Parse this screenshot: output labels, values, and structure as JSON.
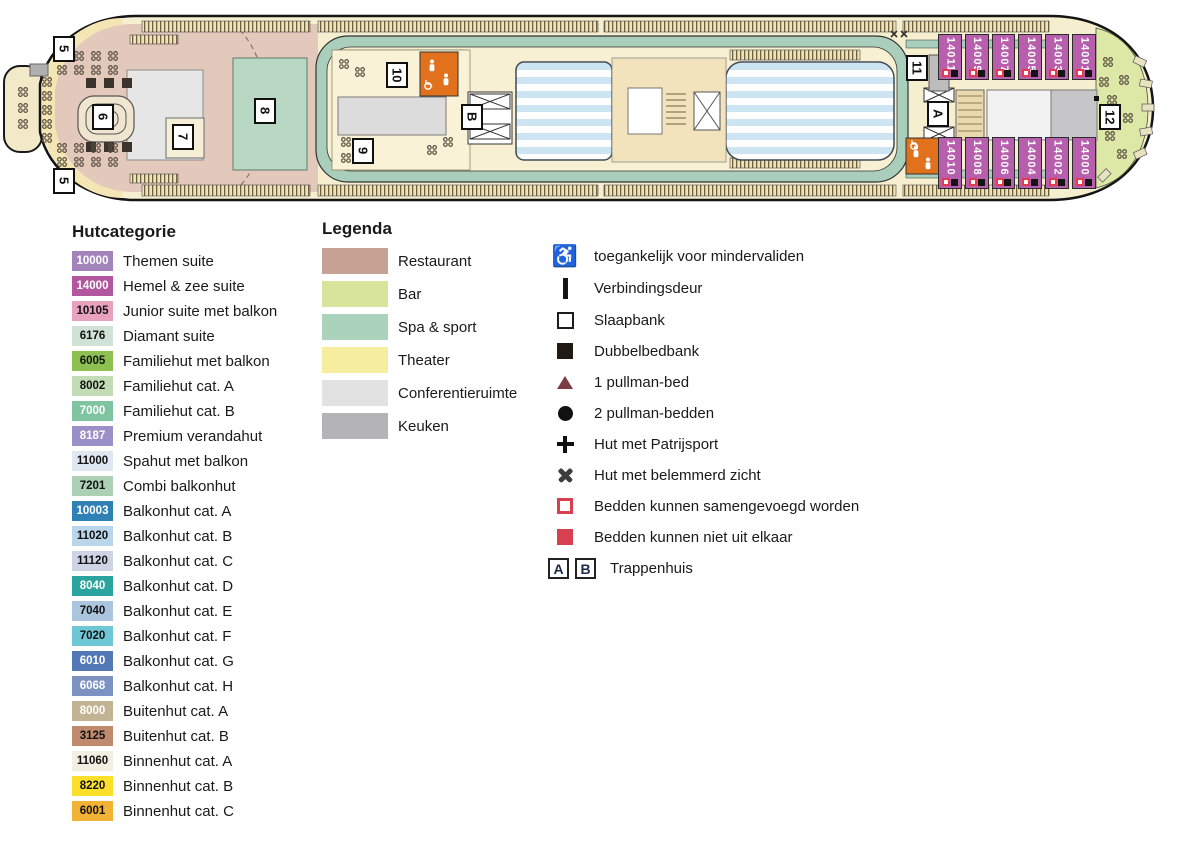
{
  "ship": {
    "markers": [
      "5",
      "5",
      "6",
      "7",
      "8",
      "9",
      "10",
      "B",
      "11",
      "A",
      "12"
    ],
    "cabins_top": [
      "14011",
      "14009",
      "14007",
      "14005",
      "14003",
      "14001"
    ],
    "cabins_bottom": [
      "14010",
      "14008",
      "14006",
      "14004",
      "14002",
      "14000"
    ]
  },
  "hutcategorie": {
    "title": "Hutcategorie",
    "items": [
      {
        "code": "10000",
        "label": "Themen suite",
        "color": "#a284bb",
        "text": "#ffffff"
      },
      {
        "code": "14000",
        "label": "Hemel & zee suite",
        "color": "#b2579e",
        "text": "#ffffff"
      },
      {
        "code": "10105",
        "label": "Junior suite met balkon",
        "color": "#e9a2bd",
        "text": "#111111"
      },
      {
        "code": "6176",
        "label": "Diamant suite",
        "color": "#cfe2d5",
        "text": "#111111"
      },
      {
        "code": "6005",
        "label": "Familiehut met balkon",
        "color": "#8cc152",
        "text": "#111111"
      },
      {
        "code": "8002",
        "label": "Familiehut cat. A",
        "color": "#c2dcb6",
        "text": "#111111"
      },
      {
        "code": "7000",
        "label": "Familiehut cat. B",
        "color": "#7fc4a1",
        "text": "#ffffff"
      },
      {
        "code": "8187",
        "label": "Premium verandahut",
        "color": "#9a90c7",
        "text": "#ffffff"
      },
      {
        "code": "11000",
        "label": "Spahut met balkon",
        "color": "#dfe8f1",
        "text": "#111111"
      },
      {
        "code": "7201",
        "label": "Combi balkonhut",
        "color": "#abd0b3",
        "text": "#111111"
      },
      {
        "code": "10003",
        "label": "Balkonhut cat. A",
        "color": "#2f80b4",
        "text": "#ffffff"
      },
      {
        "code": "11020",
        "label": "Balkonhut cat. B",
        "color": "#b9d6ea",
        "text": "#111111"
      },
      {
        "code": "11120",
        "label": "Balkonhut cat. C",
        "color": "#ccd4e6",
        "text": "#111111"
      },
      {
        "code": "8040",
        "label": "Balkonhut cat. D",
        "color": "#2ba49f",
        "text": "#ffffff"
      },
      {
        "code": "7040",
        "label": "Balkonhut cat. E",
        "color": "#abc5de",
        "text": "#111111"
      },
      {
        "code": "7020",
        "label": "Balkonhut cat. F",
        "color": "#6fc6d5",
        "text": "#111111"
      },
      {
        "code": "6010",
        "label": "Balkonhut cat. G",
        "color": "#5278b5",
        "text": "#ffffff"
      },
      {
        "code": "6068",
        "label": "Balkonhut cat. H",
        "color": "#7b92c3",
        "text": "#ffffff"
      },
      {
        "code": "8000",
        "label": "Buitenhut cat. A",
        "color": "#c2b394",
        "text": "#ffffff"
      },
      {
        "code": "3125",
        "label": "Buitenhut cat. B",
        "color": "#bf8a6d",
        "text": "#111111"
      },
      {
        "code": "11060",
        "label": "Binnenhut cat. A",
        "color": "#f3eee2",
        "text": "#111111"
      },
      {
        "code": "8220",
        "label": "Binnenhut cat. B",
        "color": "#fbdf2a",
        "text": "#111111"
      },
      {
        "code": "6001",
        "label": "Binnenhut cat. C",
        "color": "#f1b235",
        "text": "#111111"
      }
    ]
  },
  "legenda": {
    "title": "Legenda",
    "areas": [
      {
        "label": "Restaurant",
        "color": "#c7a193"
      },
      {
        "label": "Bar",
        "color": "#d8e49c"
      },
      {
        "label": "Spa & sport",
        "color": "#abd3bb"
      },
      {
        "label": "Theater",
        "color": "#f5ee9e"
      },
      {
        "label": "Conferentieruimte",
        "color": "#e2e2e2"
      },
      {
        "label": "Keuken",
        "color": "#b4b4b7"
      }
    ],
    "symbols": [
      {
        "icon": "i-wheelchair",
        "glyph": "♿",
        "label": "toegankelijk voor mindervaliden"
      },
      {
        "icon": "i-door",
        "glyph": "",
        "label": "Verbindingsdeur"
      },
      {
        "icon": "i-sq-outline",
        "glyph": "",
        "label": "Slaapbank"
      },
      {
        "icon": "i-sq-filled",
        "glyph": "",
        "label": "Dubbelbedbank"
      },
      {
        "icon": "i-triangle",
        "glyph": "",
        "label": "1 pullman-bed"
      },
      {
        "icon": "i-circle",
        "glyph": "",
        "label": "2 pullman-bedden"
      },
      {
        "icon": "i-plus",
        "glyph": "",
        "label": "Hut met Patrijsport"
      },
      {
        "icon": "i-cross",
        "glyph": "",
        "label": "Hut met belemmerd zicht"
      },
      {
        "icon": "i-red-outline",
        "glyph": "",
        "label": "Bedden kunnen samengevoegd worden"
      },
      {
        "icon": "i-red-filled",
        "glyph": "",
        "label": "Bedden kunnen niet uit elkaar"
      }
    ],
    "trappenhuis": {
      "a": "A",
      "b": "B",
      "label": "Trappenhuis"
    }
  }
}
